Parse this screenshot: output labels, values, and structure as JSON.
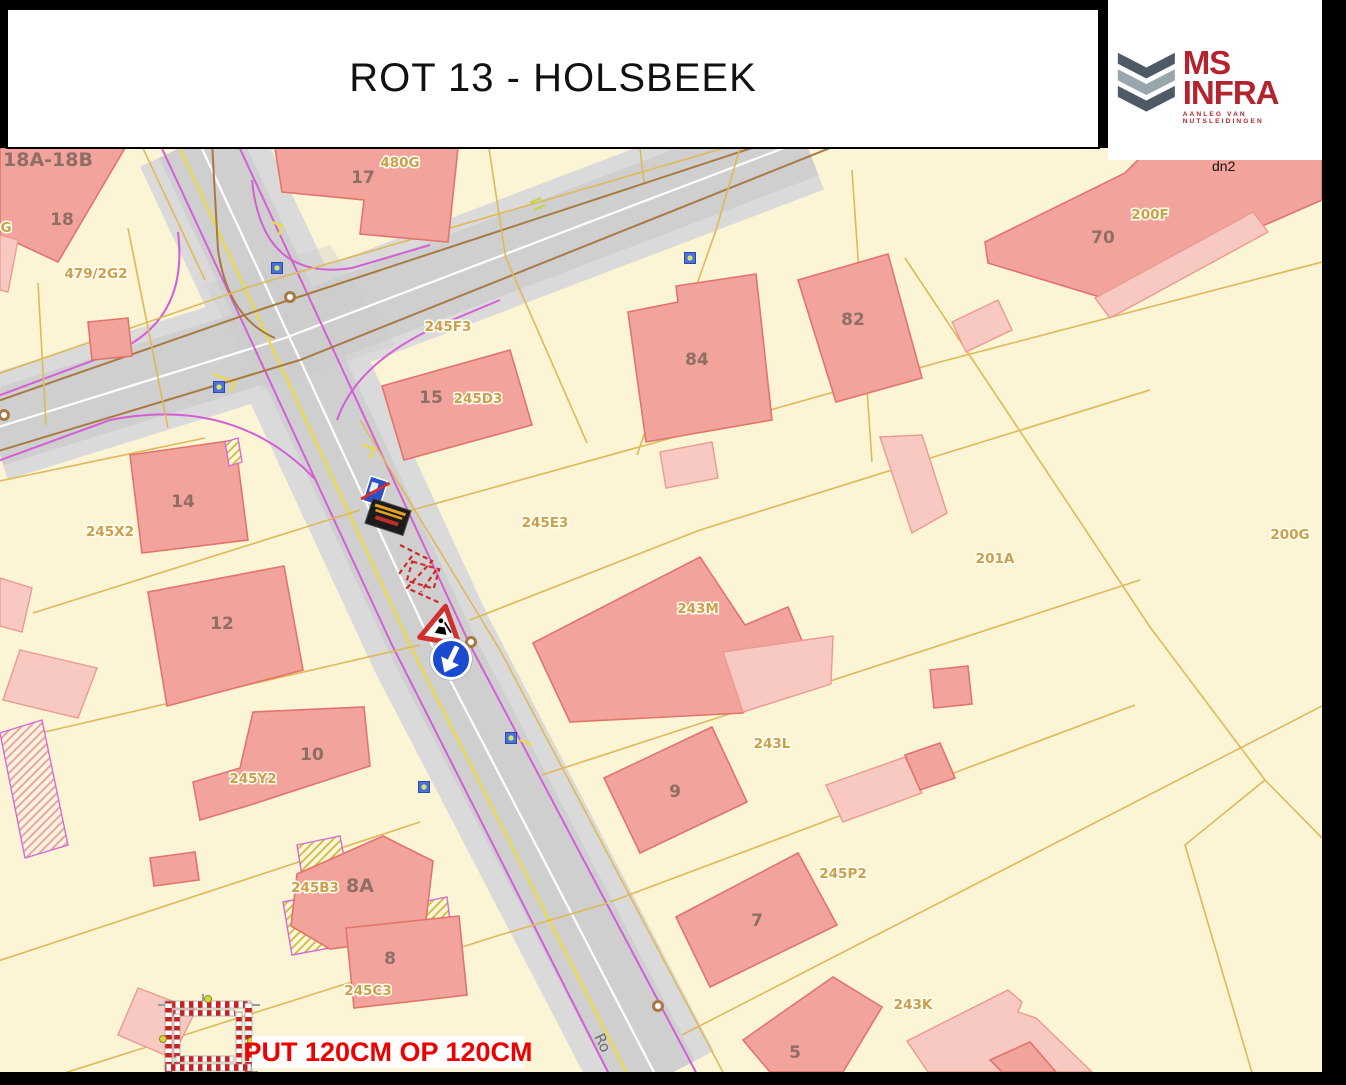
{
  "header": {
    "title": "ROT 13 - HOLSBEEK"
  },
  "logo": {
    "brand": "MS INFRA",
    "tagline": "AANLEG VAN NUTSLEIDINGEN"
  },
  "map": {
    "corner_note": "dn2",
    "street_label": "Ro",
    "pit_annotation": "PUT 120CM OP 120CM",
    "house_numbers": [
      "18A-18B",
      "18",
      "17",
      "15",
      "14",
      "12",
      "10",
      "8A",
      "8",
      "84",
      "82",
      "70",
      "9",
      "7",
      "5"
    ],
    "parcel_labels": [
      "G",
      "479/2G2",
      "480G",
      "245F3",
      "245D3",
      "245X2",
      "245E3",
      "245Y2",
      "245B3",
      "245C3",
      "243M",
      "243L",
      "243K",
      "245P2",
      "201A",
      "200G",
      "200F"
    ],
    "signs": [
      "end-restriction-sign",
      "worksite-info-board",
      "roadworks-warning-sign",
      "mandatory-direction-arrow-sign",
      "barrier-square"
    ],
    "colors": {
      "parcel_fill": "#fbf4d5",
      "building_fill": "#f2a39b",
      "building_light_fill": "#f8c9c2",
      "road_fill": "#cfcfcf",
      "sidewalk_fill": "#dadada",
      "parcel_line": "#dfb959",
      "road_edge_purple": "#d45fd4",
      "road_marking_yellow": "#ead94f",
      "utility_brown": "#a87a42",
      "annotation_red": "#ee0000",
      "brand_red": "#b5232e"
    }
  }
}
